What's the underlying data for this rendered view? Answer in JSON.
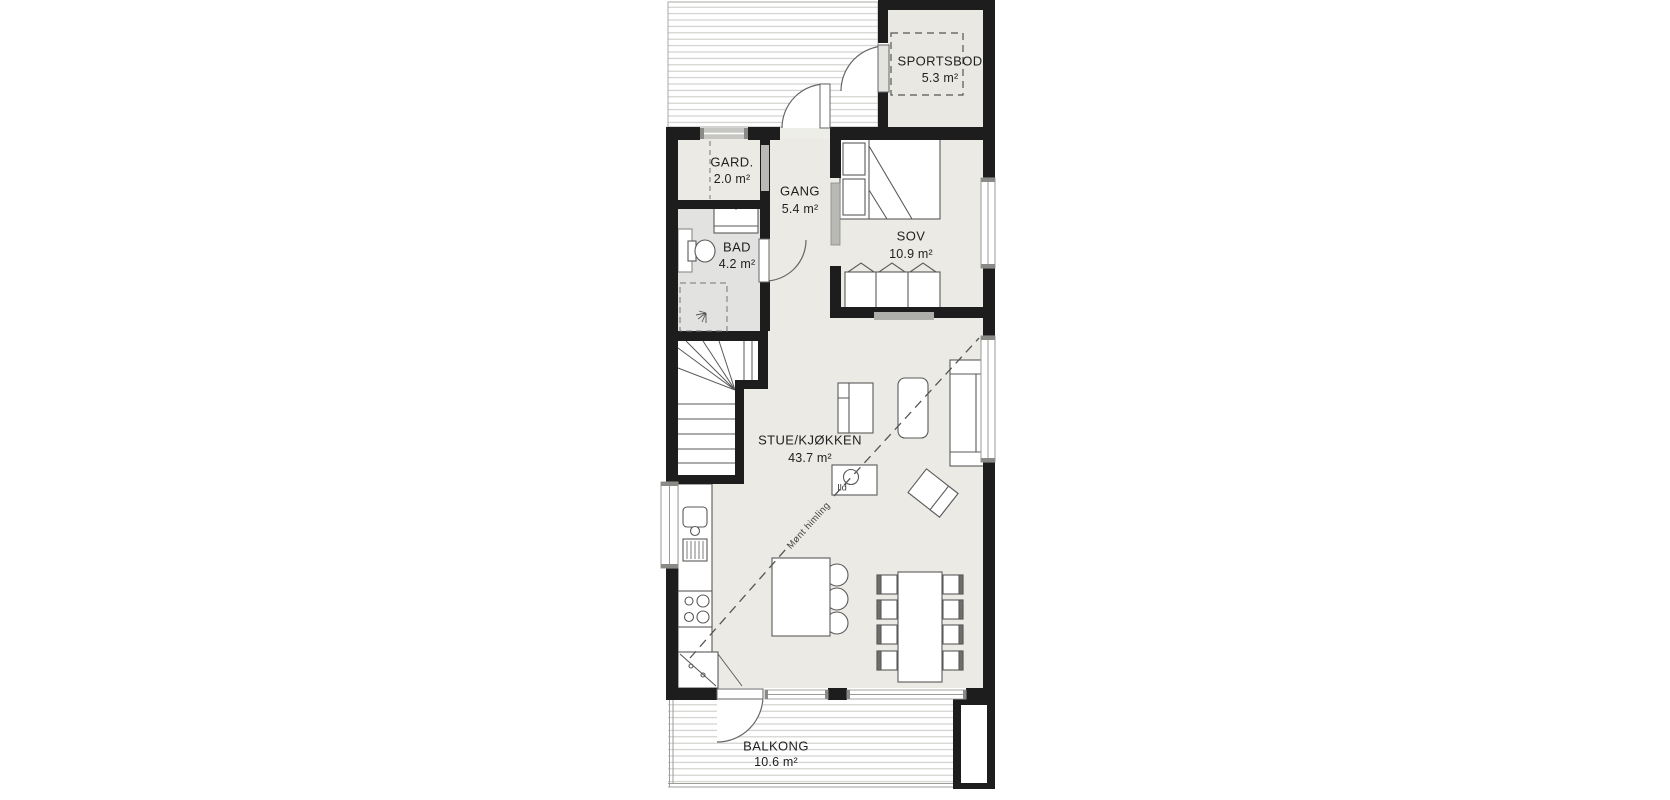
{
  "plan": {
    "rooms": [
      {
        "id": "sportsbod",
        "name": "SPORTSBOD",
        "area": "5.3 m²"
      },
      {
        "id": "gard",
        "name": "GARD.",
        "area": "2.0 m²"
      },
      {
        "id": "gang",
        "name": "GANG",
        "area": "5.4 m²"
      },
      {
        "id": "bad",
        "name": "BAD",
        "area": "4.2 m²"
      },
      {
        "id": "sov",
        "name": "SOV",
        "area": "10.9 m²"
      },
      {
        "id": "stue",
        "name": "STUE/KJØKKEN",
        "area": "43.7 m²"
      },
      {
        "id": "balkong",
        "name": "BALKONG",
        "area": "10.6 m²"
      }
    ],
    "annotations": [
      {
        "id": "fireplace",
        "text": "Ild"
      },
      {
        "id": "ceiling",
        "text": "Mønt himling"
      }
    ],
    "colors": {
      "wall": "#1d1d1d",
      "floor": "#ebeae5",
      "bathroom_floor": "#e2e2e1",
      "sportsbod_floor": "#e9e8e2",
      "deck_line": "#c9c9c5",
      "furniture_stroke": "#5a5a5a"
    }
  }
}
